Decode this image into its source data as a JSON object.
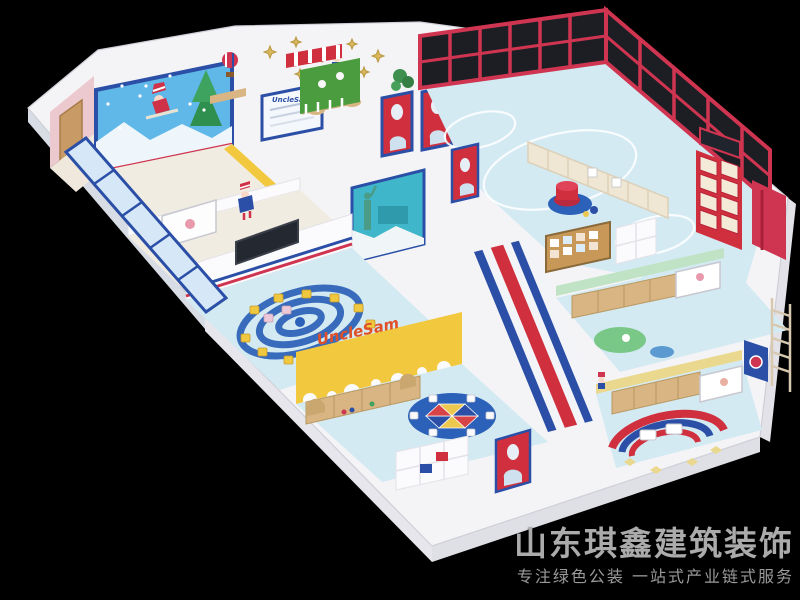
{
  "scene": {
    "background": "#000000"
  },
  "branding": {
    "company": "山东琪鑫建筑装饰",
    "slogan": "专注绿色公装  一站式产业链式服务"
  },
  "labels": {
    "wall_brand": "UncleSam",
    "sign_board": "UncleSam"
  },
  "palette": {
    "wall_white": "#f4f4f6",
    "floor_blue": "#d4eaf3",
    "accent_red": "#d0303e",
    "accent_blue": "#2b4fa6",
    "accent_yellow": "#f2c93e",
    "mint_green": "#bfe3c4",
    "trim_yellow": "#ead88e",
    "wood": "#d8b582",
    "sofa_beige": "#efe7d4",
    "mural_teal": "#3fb6c9",
    "mural_sky": "#5fb8e8",
    "glass_dark": "#1c1e24",
    "rug_blue": "#2b61b8"
  }
}
